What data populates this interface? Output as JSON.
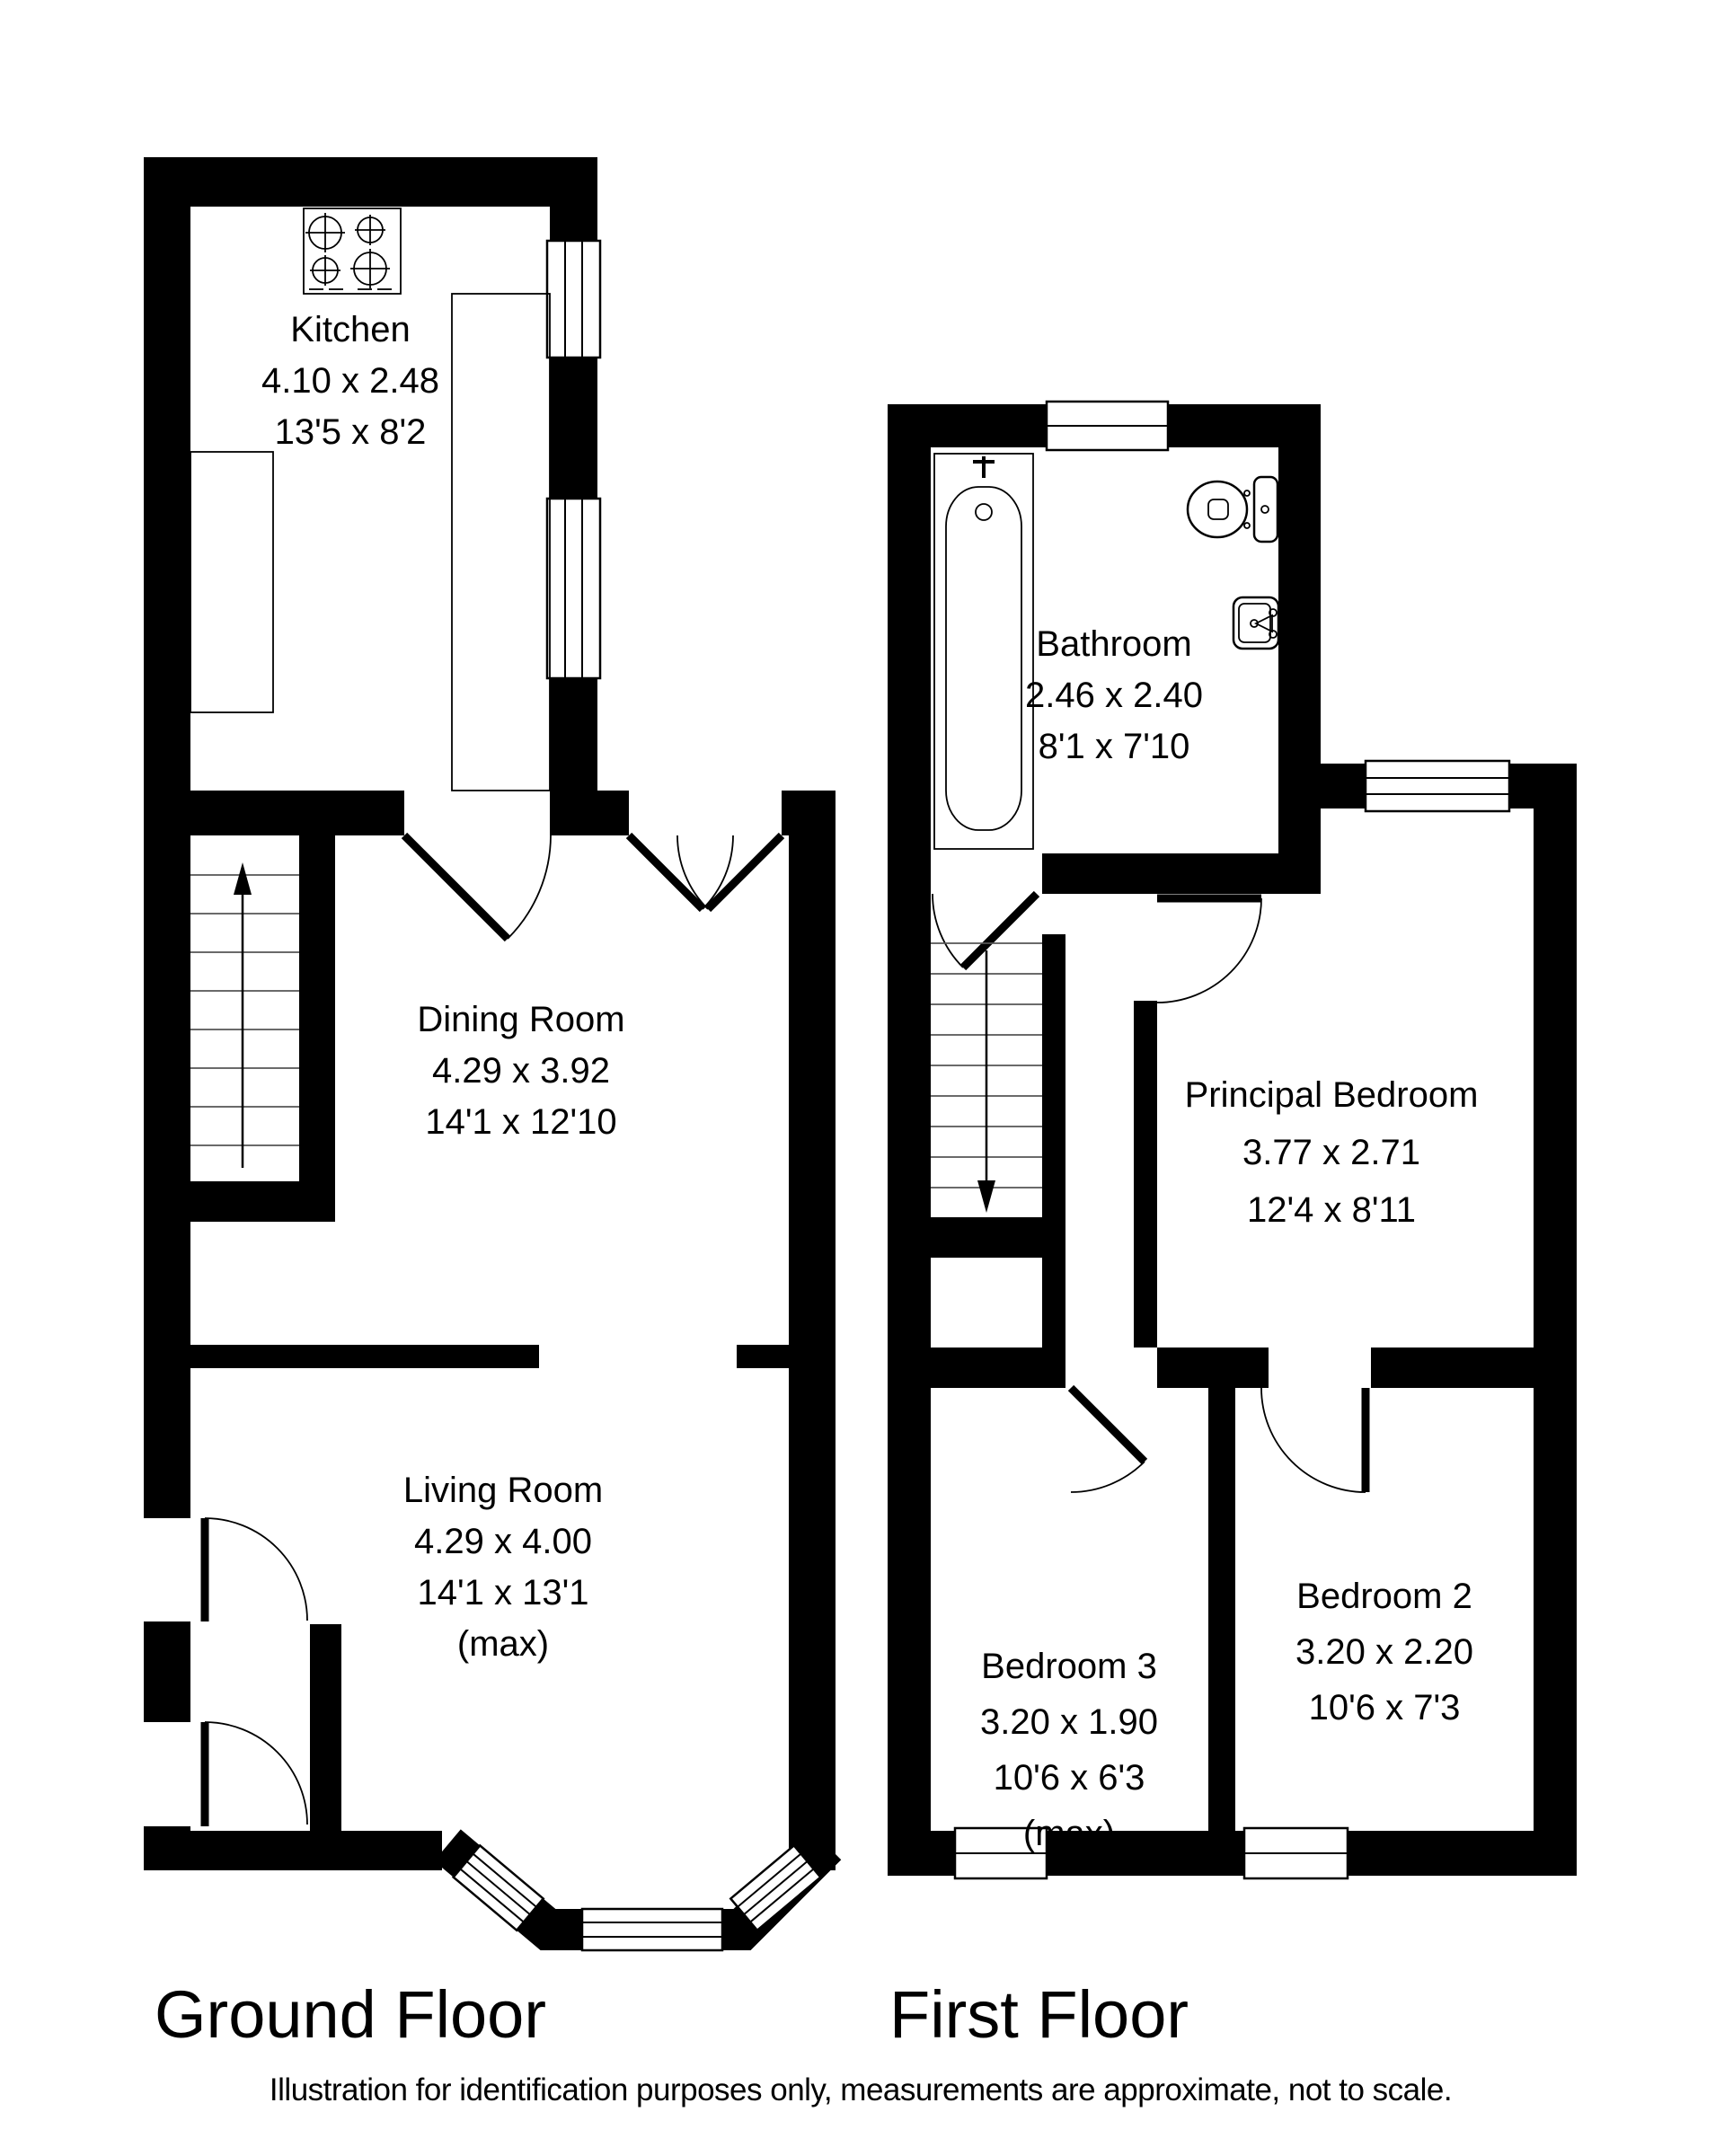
{
  "colors": {
    "background": "#ffffff",
    "walls": "#000000",
    "text": "#000000"
  },
  "floors": [
    {
      "name": "Ground Floor",
      "rooms": [
        {
          "name": "Kitchen",
          "metric": "4.10 x 2.48",
          "imperial": "13'5 x 8'2"
        },
        {
          "name": "Dining Room",
          "metric": "4.29 x 3.92",
          "imperial": "14'1 x 12'10"
        },
        {
          "name": "Living Room",
          "metric": "4.29 x 4.00",
          "imperial": "14'1 x 13'1",
          "note": "(max)"
        }
      ]
    },
    {
      "name": "First Floor",
      "rooms": [
        {
          "name": "Bathroom",
          "metric": "2.46 x 2.40",
          "imperial": "8'1 x 7'10"
        },
        {
          "name": "Principal Bedroom",
          "metric": "3.77 x 2.71",
          "imperial": "12'4 x 8'11"
        },
        {
          "name": "Bedroom 3",
          "metric": "3.20 x 1.90",
          "imperial": "10'6 x 6'3",
          "note": "(max)"
        },
        {
          "name": "Bedroom 2",
          "metric": "3.20 x 2.20",
          "imperial": "10'6 x 7'3"
        }
      ]
    }
  ],
  "fixtures": [
    "hob-icon",
    "kitchen-counter",
    "bathtub-icon",
    "toilet-icon",
    "sink-icon",
    "stairs-up-arrow-icon",
    "stairs-down-arrow-icon"
  ],
  "disclaimer": "Illustration for identification purposes only, measurements are approximate, not to scale."
}
